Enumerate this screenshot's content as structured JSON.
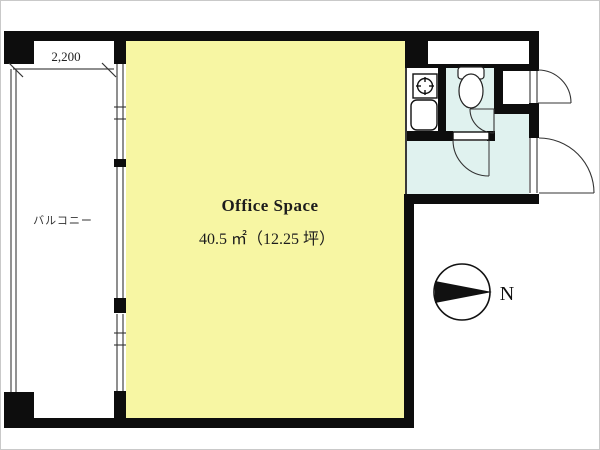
{
  "floorplan": {
    "office": {
      "label": "Office Space",
      "area": "40.5 ㎡（12.25 坪）"
    },
    "balcony": {
      "label": "バルコニー",
      "dimension": "2,200"
    },
    "compass": {
      "north_label": "N"
    },
    "colors": {
      "office_fill": "#f7f6a3",
      "wet_area_fill": "#e0f2ef",
      "wall": "#0d0d0d"
    }
  }
}
